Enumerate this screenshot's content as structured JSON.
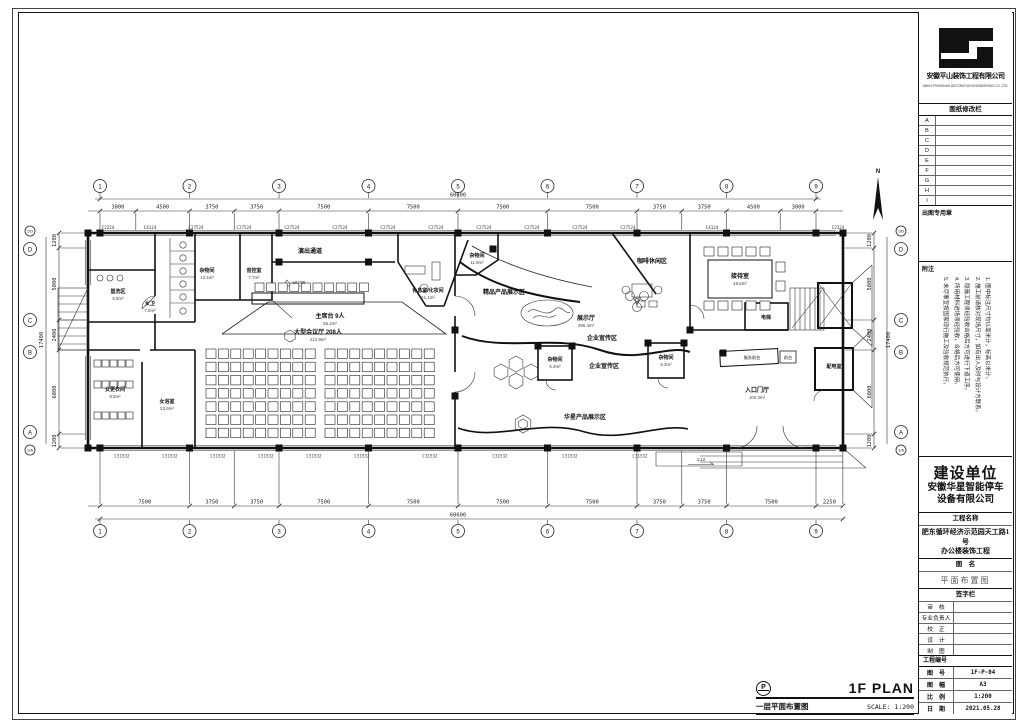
{
  "title_block": {
    "company": "安徽平山装饰工程有限公司",
    "company_sub": "ANHUI PINGSHAN DECORATION ENGINEERING CO.,LTD",
    "revision_title": "图纸修改栏",
    "revision_rows": [
      "A",
      "B",
      "C",
      "D",
      "E",
      "F",
      "G",
      "H",
      "I"
    ],
    "stamp_label": "出图专用章",
    "notes_title": "附注",
    "notes": [
      "1. 图中标注尺寸均以毫米计，标高以米计。",
      "2. 施工前请核对现场尺寸，如有出入及时与设计方联系。",
      "3. 隐蔽工程须经验收合格后方可进行下道工序。",
      "4. 所用材料进场须经验收，合格后方可使用。",
      "5. 未尽事宜按国家现行施工及验收规范执行。"
    ],
    "owner_label": "建设单位",
    "owner_name_1": "安徽华星智能停车",
    "owner_name_2": "设备有限公司",
    "project_label": "工程名称",
    "project_name_1": "肥东循环经济示范园天工路1号",
    "project_name_2": "办公楼装饰工程",
    "drawing_label": "图　名",
    "drawing_name": "平面布置图",
    "signature_label": "签字栏",
    "sig_rows": [
      "审　核",
      "专业负责人",
      "校　正",
      "设　计",
      "制　图"
    ],
    "project_no_label": "工程编号",
    "meta": [
      {
        "label": "图　号",
        "value": "1F-P-04"
      },
      {
        "label": "图　幅",
        "value": "A3"
      },
      {
        "label": "比　例",
        "value": "1:200"
      },
      {
        "label": "日　期",
        "value": "2021.05.28"
      }
    ]
  },
  "footer": {
    "bubble": "P",
    "plan_en": "1F PLAN",
    "plan_cn": "一层平面布置图",
    "scale": "SCALE:  1:200"
  },
  "plan": {
    "north": "N",
    "grid_cols": [
      "1",
      "2",
      "3",
      "4",
      "5",
      "6",
      "7",
      "8",
      "9"
    ],
    "grid_rows": [
      "1/D",
      "D",
      "C",
      "B",
      "A",
      "1/A"
    ],
    "top_total": "60600",
    "top_dims": [
      "3000",
      "4500",
      "3750",
      "3750",
      "7500",
      "7500",
      "7500",
      "7500",
      "3750",
      "3750",
      "4500",
      "3000"
    ],
    "bottom_total": "60600",
    "bottom_dims": [
      "7500",
      "3750",
      "3750",
      "7500",
      "7500",
      "7500",
      "7500",
      "3750",
      "3750",
      "7500",
      "2250"
    ],
    "left_total": "17400",
    "left_dims": [
      "1200",
      "5800",
      "2400",
      "6800",
      "1200"
    ],
    "right_total": "17400",
    "right_dims": [
      "1200",
      "5800",
      "2400",
      "6800",
      "1200"
    ],
    "top_windows": [
      "C2224",
      "C4124",
      "C27524",
      "C27524",
      "C27524",
      "C27524",
      "C27524",
      "C27524",
      "C27524",
      "C27524",
      "C27524",
      "C27524",
      "C4124",
      "C2324"
    ],
    "bottom_windows": [
      "C31532",
      "C31532",
      "C31532",
      "C31532",
      "C31532",
      "C31532",
      "C31532",
      "C31532",
      "C31532",
      "C31532"
    ],
    "rooms": [
      {
        "name": "盥洗区",
        "area": "5.9m²"
      },
      {
        "name": "女卫",
        "area": "7.0m²"
      },
      {
        "name": "杂物间",
        "area": "13.4m²"
      },
      {
        "name": "音控室",
        "area": "7.7m²"
      },
      {
        "name": "演出通道",
        "area": ""
      },
      {
        "name": "休息室/化妆间",
        "area": "21.1m²"
      },
      {
        "name": "主席台 9人",
        "area": "66.4m²"
      },
      {
        "name": "大型会议厅 208人",
        "area": "212.9m²"
      },
      {
        "name": "女更衣间",
        "area": "9.3m²"
      },
      {
        "name": "女浴室",
        "area": "23.9m²"
      },
      {
        "name": "杂物间",
        "area": "11.9m²"
      },
      {
        "name": "精品产品展示区",
        "area": ""
      },
      {
        "name": "展示厅",
        "area": "295.4m²"
      },
      {
        "name": "咖啡休闲区",
        "area": ""
      },
      {
        "name": "企业宣传区",
        "area": ""
      },
      {
        "name": "企业宣传区",
        "area": ""
      },
      {
        "name": "杂物间",
        "area": "5.3m²"
      },
      {
        "name": "杂物间",
        "area": "5.3m²"
      },
      {
        "name": "华星产品展示区",
        "area": ""
      },
      {
        "name": "接待室",
        "area": "48.5m²"
      },
      {
        "name": "电梯",
        "area": ""
      },
      {
        "name": "服务前台",
        "area": ""
      },
      {
        "name": "前台",
        "area": ""
      },
      {
        "name": "入口门厅",
        "area": "100.3m²"
      },
      {
        "name": "配电室",
        "area": ""
      }
    ],
    "levels": {
      "zero": "±0.000",
      "ramp": "1:12"
    }
  }
}
